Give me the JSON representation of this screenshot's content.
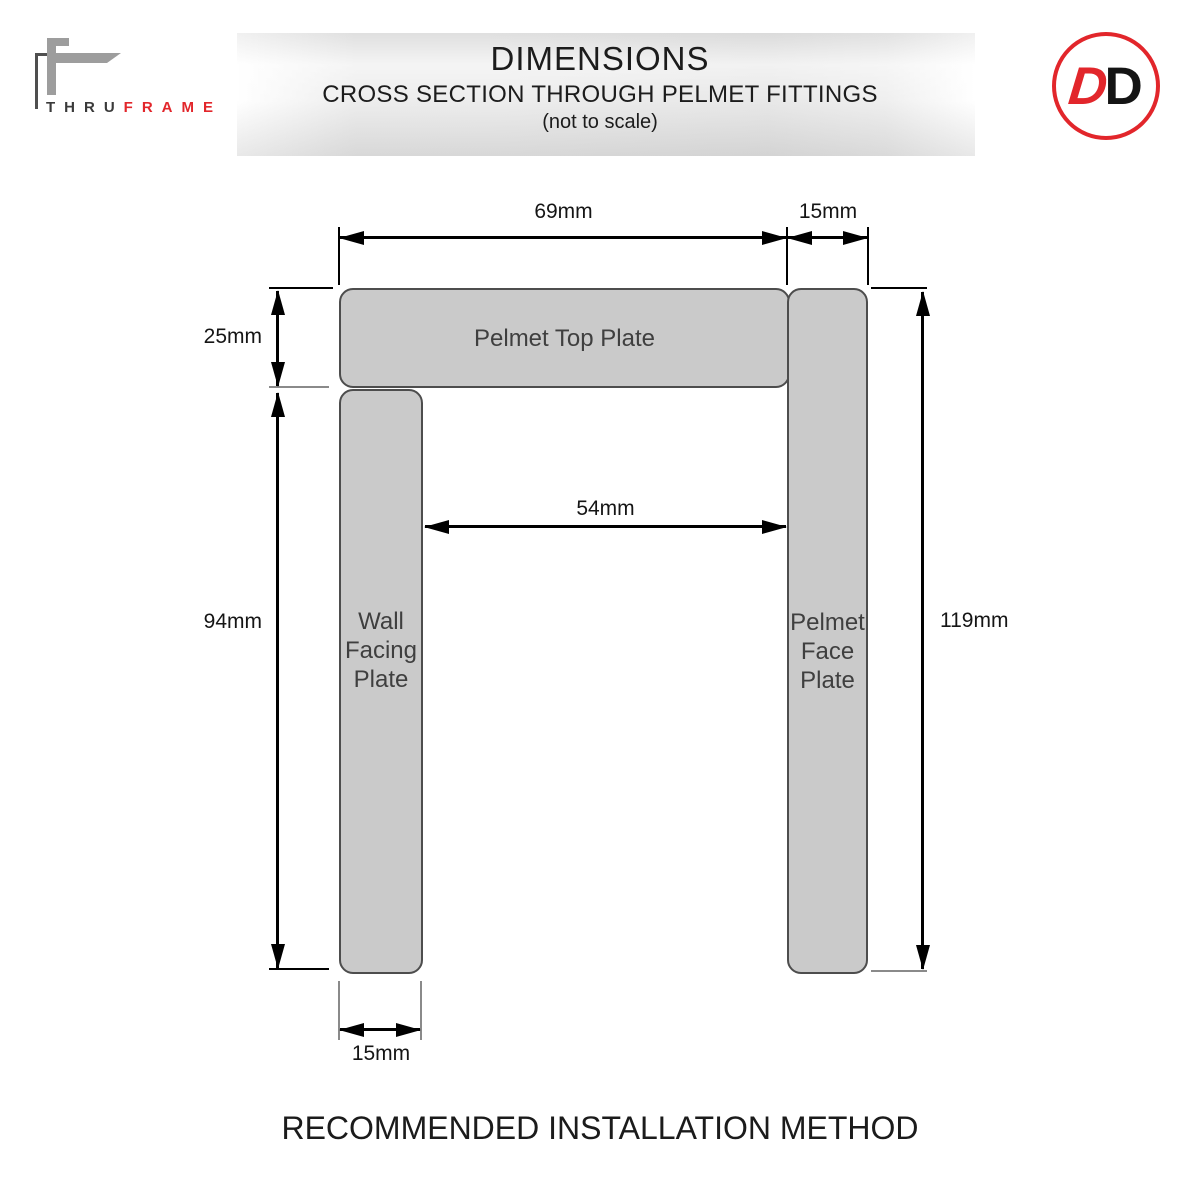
{
  "header": {
    "brand": {
      "thru": "THRU",
      "frame": "FRAME"
    },
    "title": "DIMENSIONS",
    "subtitle": "CROSS SECTION THROUGH PELMET FITTINGS",
    "scale_note": "(not to scale)",
    "badge": {
      "d1": "D",
      "d2": "D"
    }
  },
  "diagram": {
    "plates": {
      "top": {
        "label": "Pelmet Top Plate"
      },
      "wall": {
        "line1": "Wall",
        "line2": "Facing",
        "line3": "Plate"
      },
      "face": {
        "line1": "Pelmet",
        "line2": "Face",
        "line3": "Plate"
      }
    },
    "dims": {
      "top_plate_width": "69mm",
      "face_plate_width": "15mm",
      "top_plate_thickness": "25mm",
      "wall_plate_height": "94mm",
      "inner_gap": "54mm",
      "overall_height": "119mm",
      "wall_plate_width": "15mm"
    }
  },
  "footer": {
    "title": "RECOMMENDED INSTALLATION METHOD"
  },
  "colors": {
    "accent_red": "#e2262b",
    "plate_fill": "#cacaca",
    "plate_border": "#4d4d4d"
  }
}
